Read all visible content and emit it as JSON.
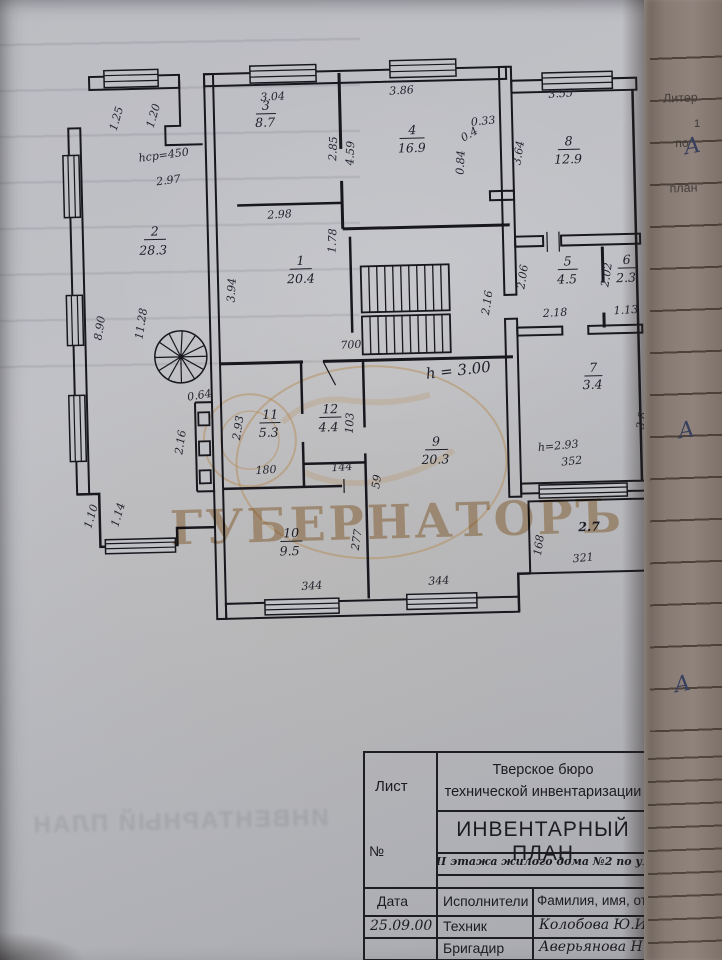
{
  "watermark": {
    "text": "ГУБЕРНАТОРЪ"
  },
  "bleedthrough_text": "ИНВЕНТАРНЫЙ ПЛАН",
  "right_margin": {
    "header_line1": "Литер",
    "header_line2": "по",
    "header_line3": "план",
    "row_number": "1",
    "mark1": "А",
    "mark2": "А",
    "mark3": "А"
  },
  "plan": {
    "balcony_area": "2.7",
    "rooms": [
      {
        "n": "1",
        "a": "20.4"
      },
      {
        "n": "2",
        "a": "28.3"
      },
      {
        "n": "3",
        "a": "8.7"
      },
      {
        "n": "4",
        "a": "16.9"
      },
      {
        "n": "5",
        "a": "4.5"
      },
      {
        "n": "6",
        "a": "2.3"
      },
      {
        "n": "7",
        "a": "3.4"
      },
      {
        "n": "8",
        "a": "12.9"
      },
      {
        "n": "9",
        "a": "20.3"
      },
      {
        "n": "10",
        "a": "9.5"
      },
      {
        "n": "11",
        "a": "5.3"
      },
      {
        "n": "12",
        "a": "4.4"
      }
    ],
    "dims": [
      {
        "v": "1.25"
      },
      {
        "v": "1.20"
      },
      {
        "v": "hср=450"
      },
      {
        "v": "2.97"
      },
      {
        "v": "8.90"
      },
      {
        "v": "11.28"
      },
      {
        "v": "0.64"
      },
      {
        "v": "2.16"
      },
      {
        "v": "1.10"
      },
      {
        "v": "1.14"
      },
      {
        "v": "3.04"
      },
      {
        "v": "2.85"
      },
      {
        "v": "3.86"
      },
      {
        "v": "4.59"
      },
      {
        "v": "0.33"
      },
      {
        "v": "0.4"
      },
      {
        "v": "0.84"
      },
      {
        "v": "3.64"
      },
      {
        "v": "3.55"
      },
      {
        "v": "2.98"
      },
      {
        "v": "1.78"
      },
      {
        "v": "3.94"
      },
      {
        "v": "700"
      },
      {
        "v": "2.16"
      },
      {
        "v": "2.06"
      },
      {
        "v": "2.18"
      },
      {
        "v": "2.02"
      },
      {
        "v": "1.13"
      },
      {
        "v": "2.93"
      },
      {
        "v": "180"
      },
      {
        "v": "103"
      },
      {
        "v": "144"
      },
      {
        "v": "59"
      },
      {
        "v": "277"
      },
      {
        "v": "344"
      },
      {
        "v": "344"
      },
      {
        "v": "3.8"
      },
      {
        "v": "h=2.93"
      },
      {
        "v": "352"
      },
      {
        "v": "168"
      },
      {
        "v": "321"
      },
      {
        "v": "h = 3.00"
      }
    ]
  },
  "title_block": {
    "sheet_label": "Лист",
    "number_label": "№",
    "org_line1": "Тверское бюро",
    "org_line2": "технической инвентаризации",
    "doc_title": "ИНВЕНТАРНЫЙ ПЛАН",
    "subtitle": "II этажа жилого дома №2 по ул. Тверевод",
    "col_date": "Дата",
    "col_executors": "Исполнители",
    "col_name": "Фамилия, имя, отчест",
    "row1_date": "25.09.00",
    "row1_role": "Техник",
    "row1_name": "Колобова Ю.И.",
    "row2_role": "Бригадир",
    "row2_name": "Аверьянова Н.В.",
    "row3_role": "Директор",
    "row3_name": "Аникинова О.М."
  }
}
